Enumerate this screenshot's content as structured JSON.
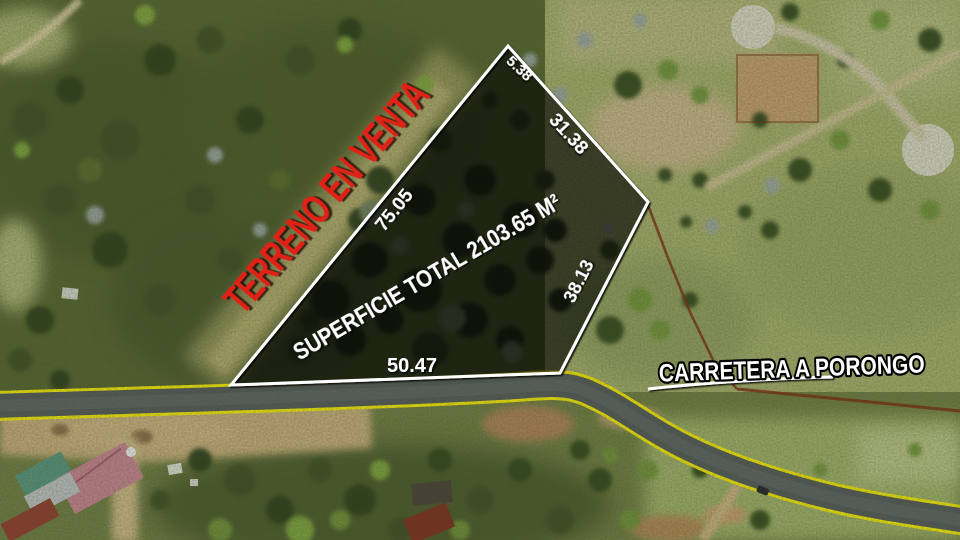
{
  "annotation": {
    "sale_label": "TERRENO EN VENTA",
    "area_label": "SUPERFICIE TOTAL 2103.65 M²",
    "road_label": "CARRETERA A PORONGO",
    "dimensions": {
      "top": "5.38",
      "upper_right": "31.38",
      "left": "75.05",
      "right": "38.13",
      "bottom": "50.47"
    },
    "colors": {
      "sale_text": "#e02318",
      "boundary_line": "#ffffff",
      "road_edge_line": "#f0e40c",
      "dimension_text": "#ffffff",
      "road_label_outline": "#000000"
    }
  }
}
